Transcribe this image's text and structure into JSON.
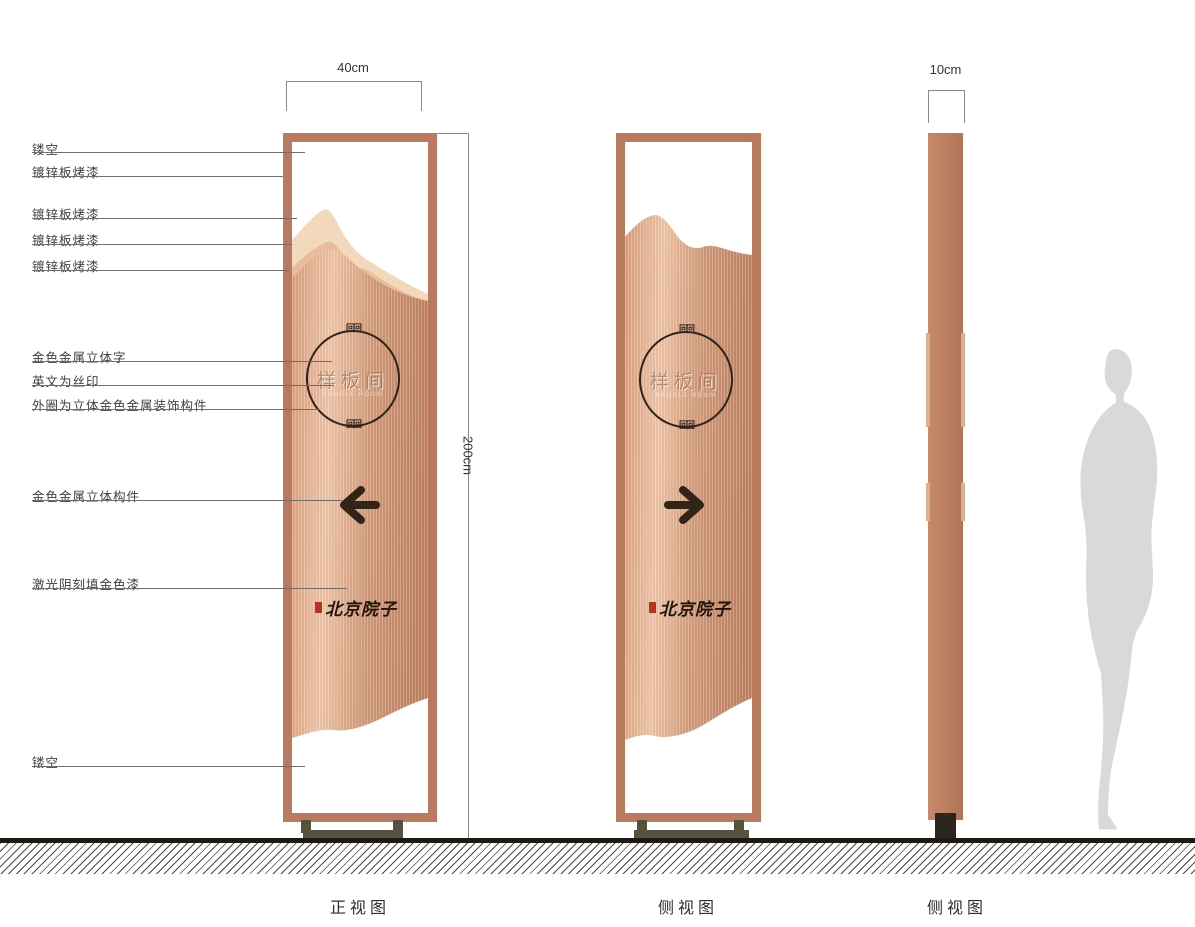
{
  "callouts": [
    {
      "text": "镂空"
    },
    {
      "text": "镀锌板烤漆"
    },
    {
      "text": "镀锌板烤漆"
    },
    {
      "text": "镀锌板烤漆"
    },
    {
      "text": "镀锌板烤漆"
    },
    {
      "text": "金色金属立体字"
    },
    {
      "text": "英文为丝印"
    },
    {
      "text": "外圈为立体金色金属装饰构件"
    },
    {
      "text": "金色金属立体构件"
    },
    {
      "text": "激光阴刻填金色漆"
    },
    {
      "text": "镂空"
    }
  ],
  "dimensions": {
    "front_width": "40cm",
    "height": "200cm",
    "side_width": "10cm"
  },
  "views": [
    {
      "label": "正视图"
    },
    {
      "label": "侧视图"
    },
    {
      "label": "侧视图"
    }
  ],
  "sign": {
    "circle_text": "样板间",
    "english_caption": "SAMPLE ROOM",
    "brand_text": "北京院子",
    "ornament": "回回"
  },
  "colors": {
    "frame": "#b97a5e",
    "panel_light": "#eec3a6",
    "panel_dark": "#bd8161",
    "ink": "#33241a",
    "seal_red": "#b5341f",
    "base": "#55523f",
    "silhouette": "#d9d9d9"
  }
}
